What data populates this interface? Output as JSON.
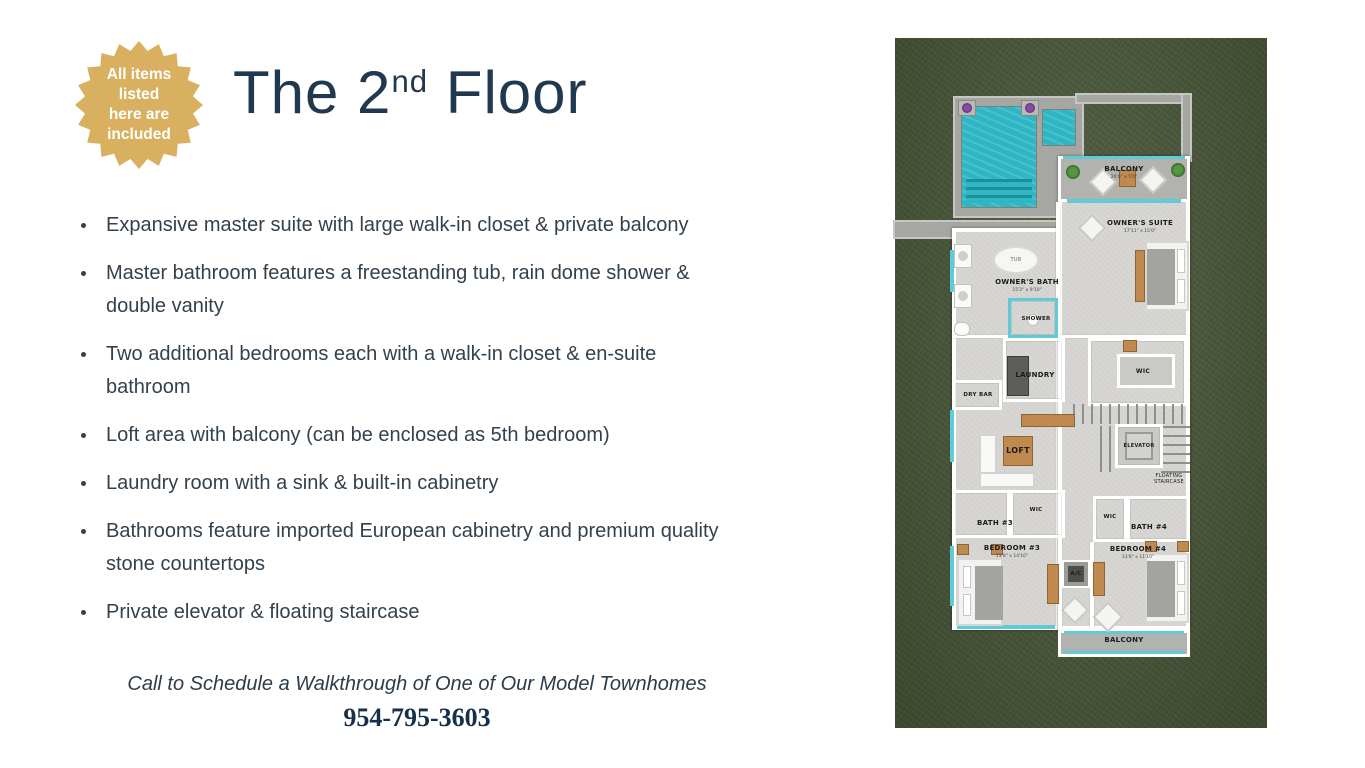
{
  "badge": {
    "lines": [
      "All items",
      "listed",
      "here are",
      "included"
    ]
  },
  "title": {
    "prefix": "The 2",
    "superscript": "nd",
    "suffix": " Floor"
  },
  "features": [
    "Expansive master suite with large walk-in closet & private balcony",
    "Master bathroom features a freestanding tub, rain dome shower & double vanity",
    "Two additional bedrooms each with a walk-in closet & en-suite bathroom",
    "Loft area with balcony (can be enclosed as 5th bedroom)",
    "Laundry room with a sink & built-in cabinetry",
    "Bathrooms feature imported European cabinetry and premium quality stone countertops",
    "Private elevator & floating staircase"
  ],
  "cta": {
    "line": "Call to Schedule a Walkthrough of One of Our Model Townhomes",
    "phone": "954-795-3603"
  },
  "floorplan": {
    "rooms": {
      "balcony_top": {
        "name": "BALCONY",
        "dim": "20'0\" x 5'0\""
      },
      "owners_suite": {
        "name": "OWNER'S SUITE",
        "dim": "17'11\" x 15'0\""
      },
      "tub": "TUB",
      "owners_bath": {
        "name": "OWNER'S BATH",
        "dim": "15'2\" x 9'10\""
      },
      "shower": "SHOWER",
      "laundry": "LAUNDRY",
      "dry_bar": "DRY BAR",
      "wic_master": "WIC",
      "loft": "LOFT",
      "elevator": "ELEVATOR",
      "floating_staircase": "FLOATING STAIRCASE",
      "bath3": "BATH #3",
      "wic3": "WIC",
      "wic4": "WIC",
      "bath4": "BATH #4",
      "bedroom3": {
        "name": "BEDROOM #3",
        "dim": "13'8\" x 14'10\""
      },
      "ac": "A/C",
      "bedroom4": {
        "name": "BEDROOM #4",
        "dim": "13'8\" x 11'10\""
      },
      "balcony_bottom": "BALCONY"
    },
    "colors": {
      "grass": "#4e5d3c",
      "pool": "#2eb6c4",
      "deck": "#a6a6a2",
      "floor": "#d7d6d3",
      "glass": "#5fcbd6"
    }
  },
  "colors": {
    "accent_gold": "#d8b05f",
    "title_navy": "#21394f",
    "body_text": "#33414d"
  }
}
